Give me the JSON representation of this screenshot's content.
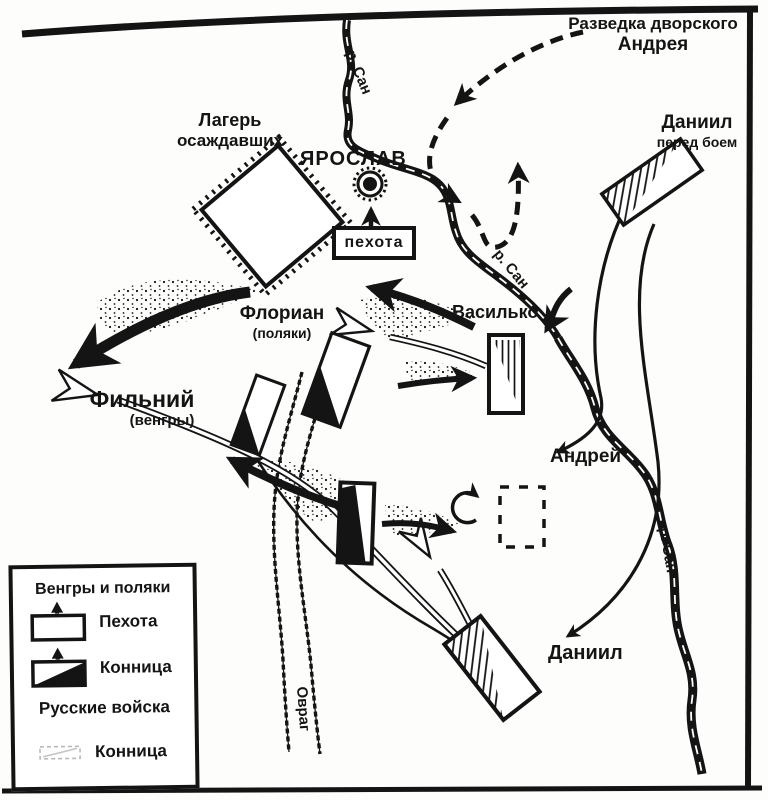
{
  "map": {
    "ink_color": "#141414",
    "paper_color": "#fdfdfb",
    "labels": {
      "recon_line1": "Разведка дворского",
      "recon_line2": "Андрея",
      "camp_line1": "Лагерь",
      "camp_line2": "осаждавших",
      "town": "ЯРОСЛАВ",
      "infantry_box": "пехота",
      "daniil_before_line1": "Даниил",
      "daniil_before_line2": "перед боем",
      "vasilko": "Василько",
      "florian_line1": "Флориан",
      "florian_line2": "(поляки)",
      "filniy_line1": "Фильний",
      "filniy_line2": "(венгры)",
      "andrey": "Андрей",
      "daniil": "Даниил",
      "ravine": "Овраг",
      "river": "р. Сан"
    },
    "legend": {
      "group1_title": "Венгры и поляки",
      "group1_items": [
        {
          "symbol": "infantry-rect-symbol",
          "label": "Пехота"
        },
        {
          "symbol": "cavalry-rect-symbol",
          "label": "Конница"
        }
      ],
      "group2_title": "Русские войска",
      "group2_items": [
        {
          "symbol": "russian-cavalry-faint-symbol",
          "label": "Конница"
        }
      ]
    }
  }
}
